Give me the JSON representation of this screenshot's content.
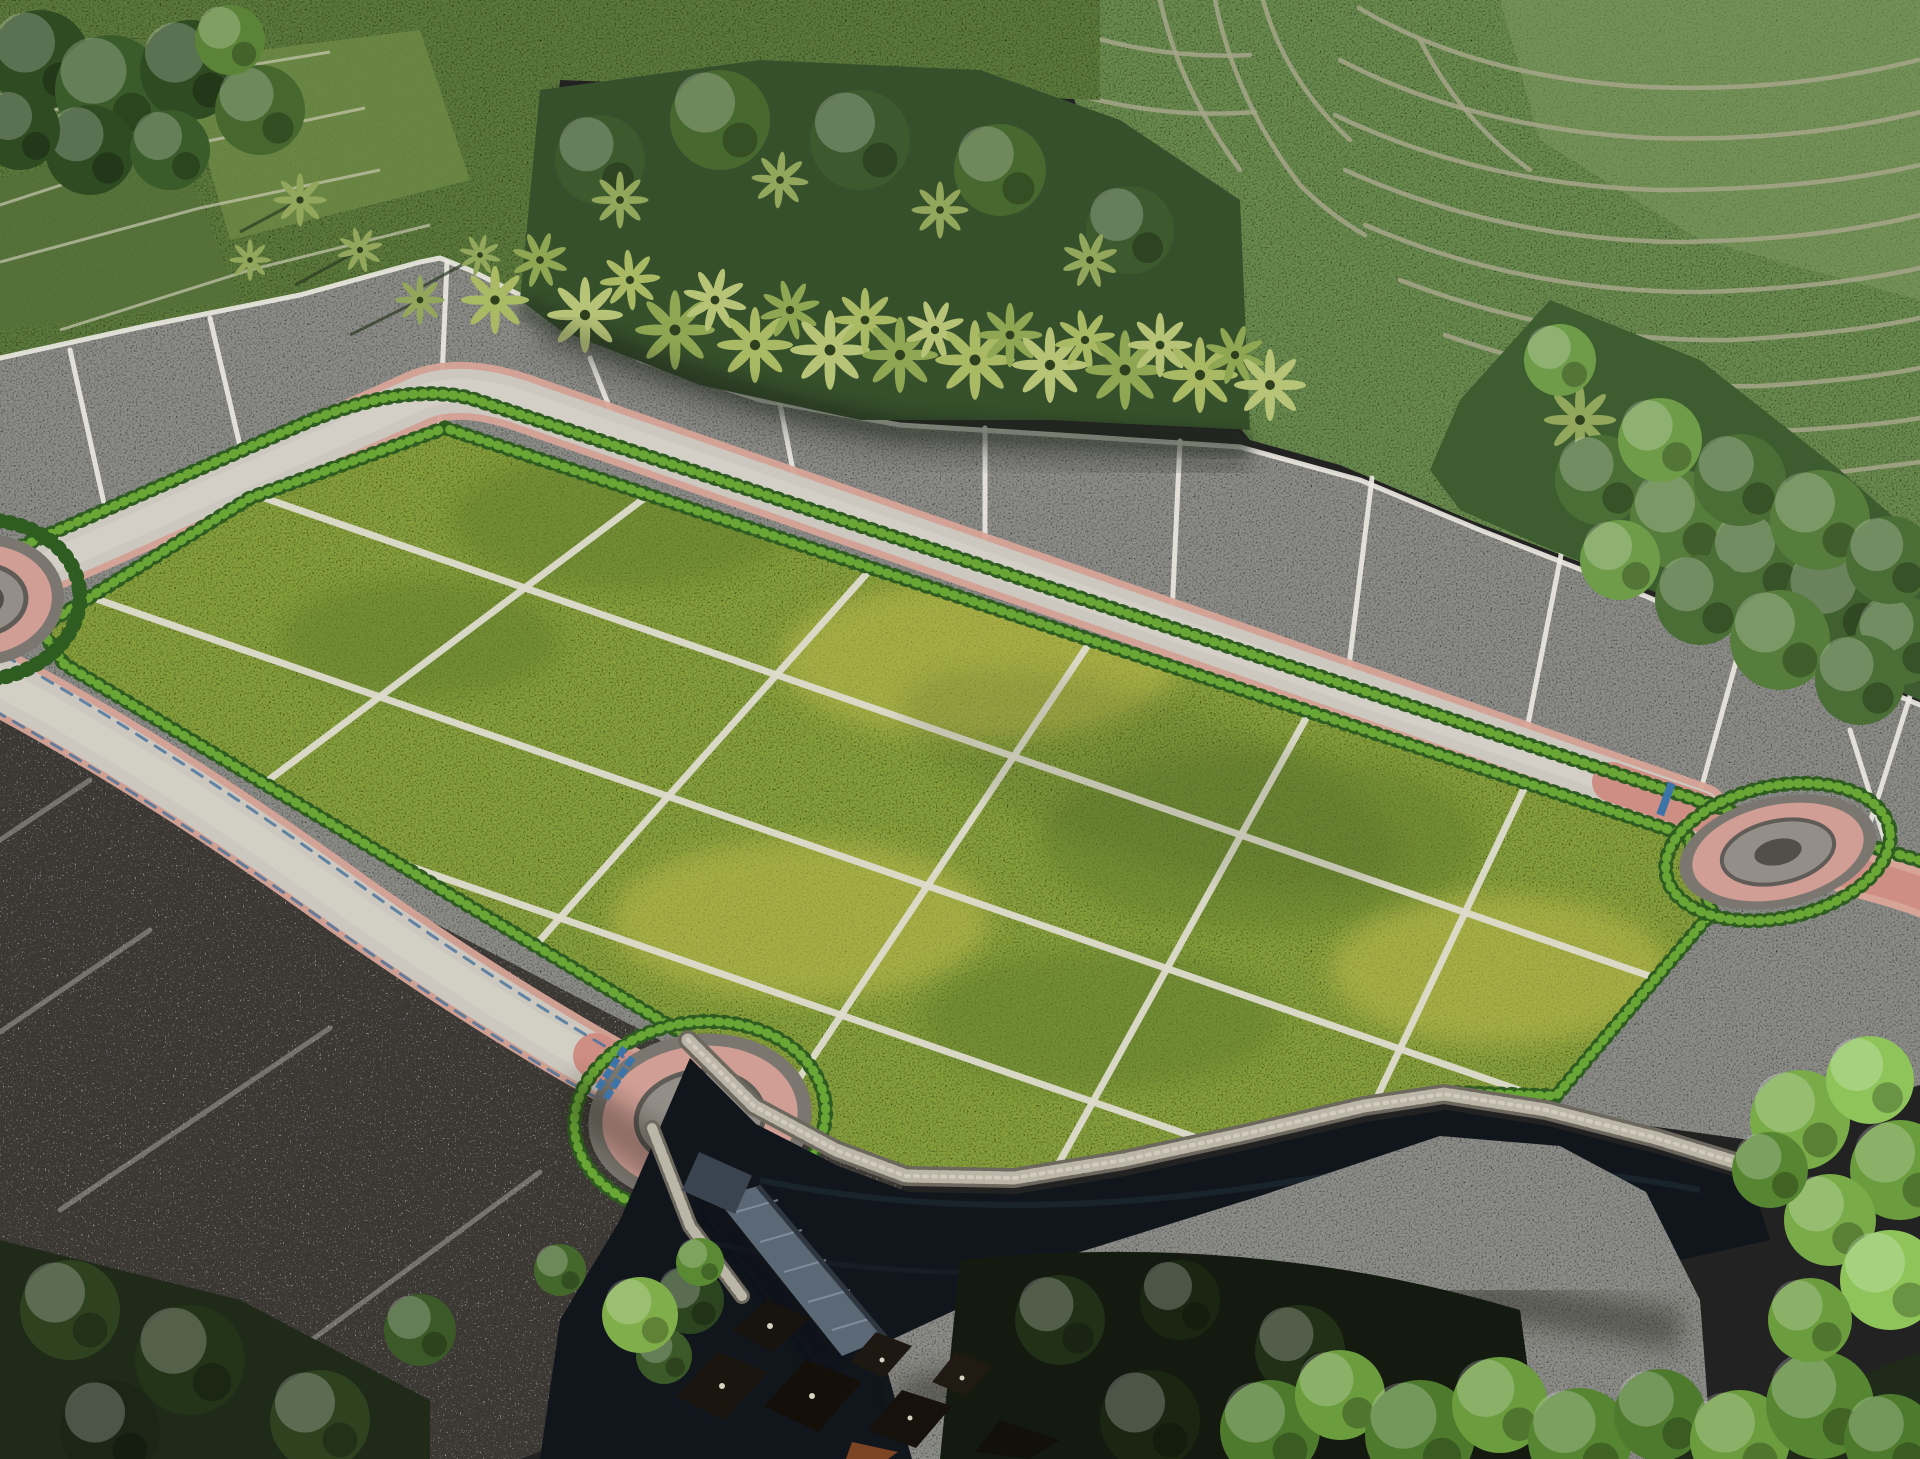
{
  "meta": {
    "title": "aerial-masterplan-render",
    "description": "Aerial drone-style render of a terraced land subdivision: bright green plots inside a hedge-lined loop road with roundabouts, grayscale surrounding fields, rice terraces and palm forest above, stone wall, river, bridge and village below"
  },
  "site": {
    "green_plot_rows": 4,
    "green_plot_columns": 6,
    "roundabouts": 3,
    "bridges": 1
  },
  "palette": {
    "field_green": "#5d7a3d",
    "field_green_dark": "#4c6632",
    "terrace_green": "#6b8b50",
    "terrace_line": "#a6a689",
    "palm_under": "#37502c",
    "palm_frond": "#a9b964",
    "forest_green": "#3d5c2f",
    "gravel": "#8d8d89",
    "gravel_slope": "#8e8e8a",
    "gravel_dark": "#302f2b",
    "plot_line": "#e9e7df",
    "grass": "#87a03d",
    "grass_dark": "#647f2f",
    "grass_yellow": "#c0bb4d",
    "path_white": "#dedbce",
    "road": "#ccc8bf",
    "road_pink": "#d7a498",
    "road_pink_deep": "#cf8e84",
    "hedge_dark": "#2f5c20",
    "hedge_light": "#6aa636",
    "ring_gray": "#7b766f",
    "ring_pink": "#d09e95",
    "ring_inner": "#948e88",
    "ring_center": "#524e4a",
    "wall_light": "#bcb6a8",
    "wall_dark": "#6d685e",
    "water": "#10161c",
    "bridge": "#5b6875",
    "roof_dark": "#17130e",
    "roof_orange": "#7c4423",
    "crossing_blue": "#3d74a8",
    "tree_bright": "#79ab48",
    "tree_mid": "#4e7a2e",
    "tree_dark": "#1f2a18"
  }
}
